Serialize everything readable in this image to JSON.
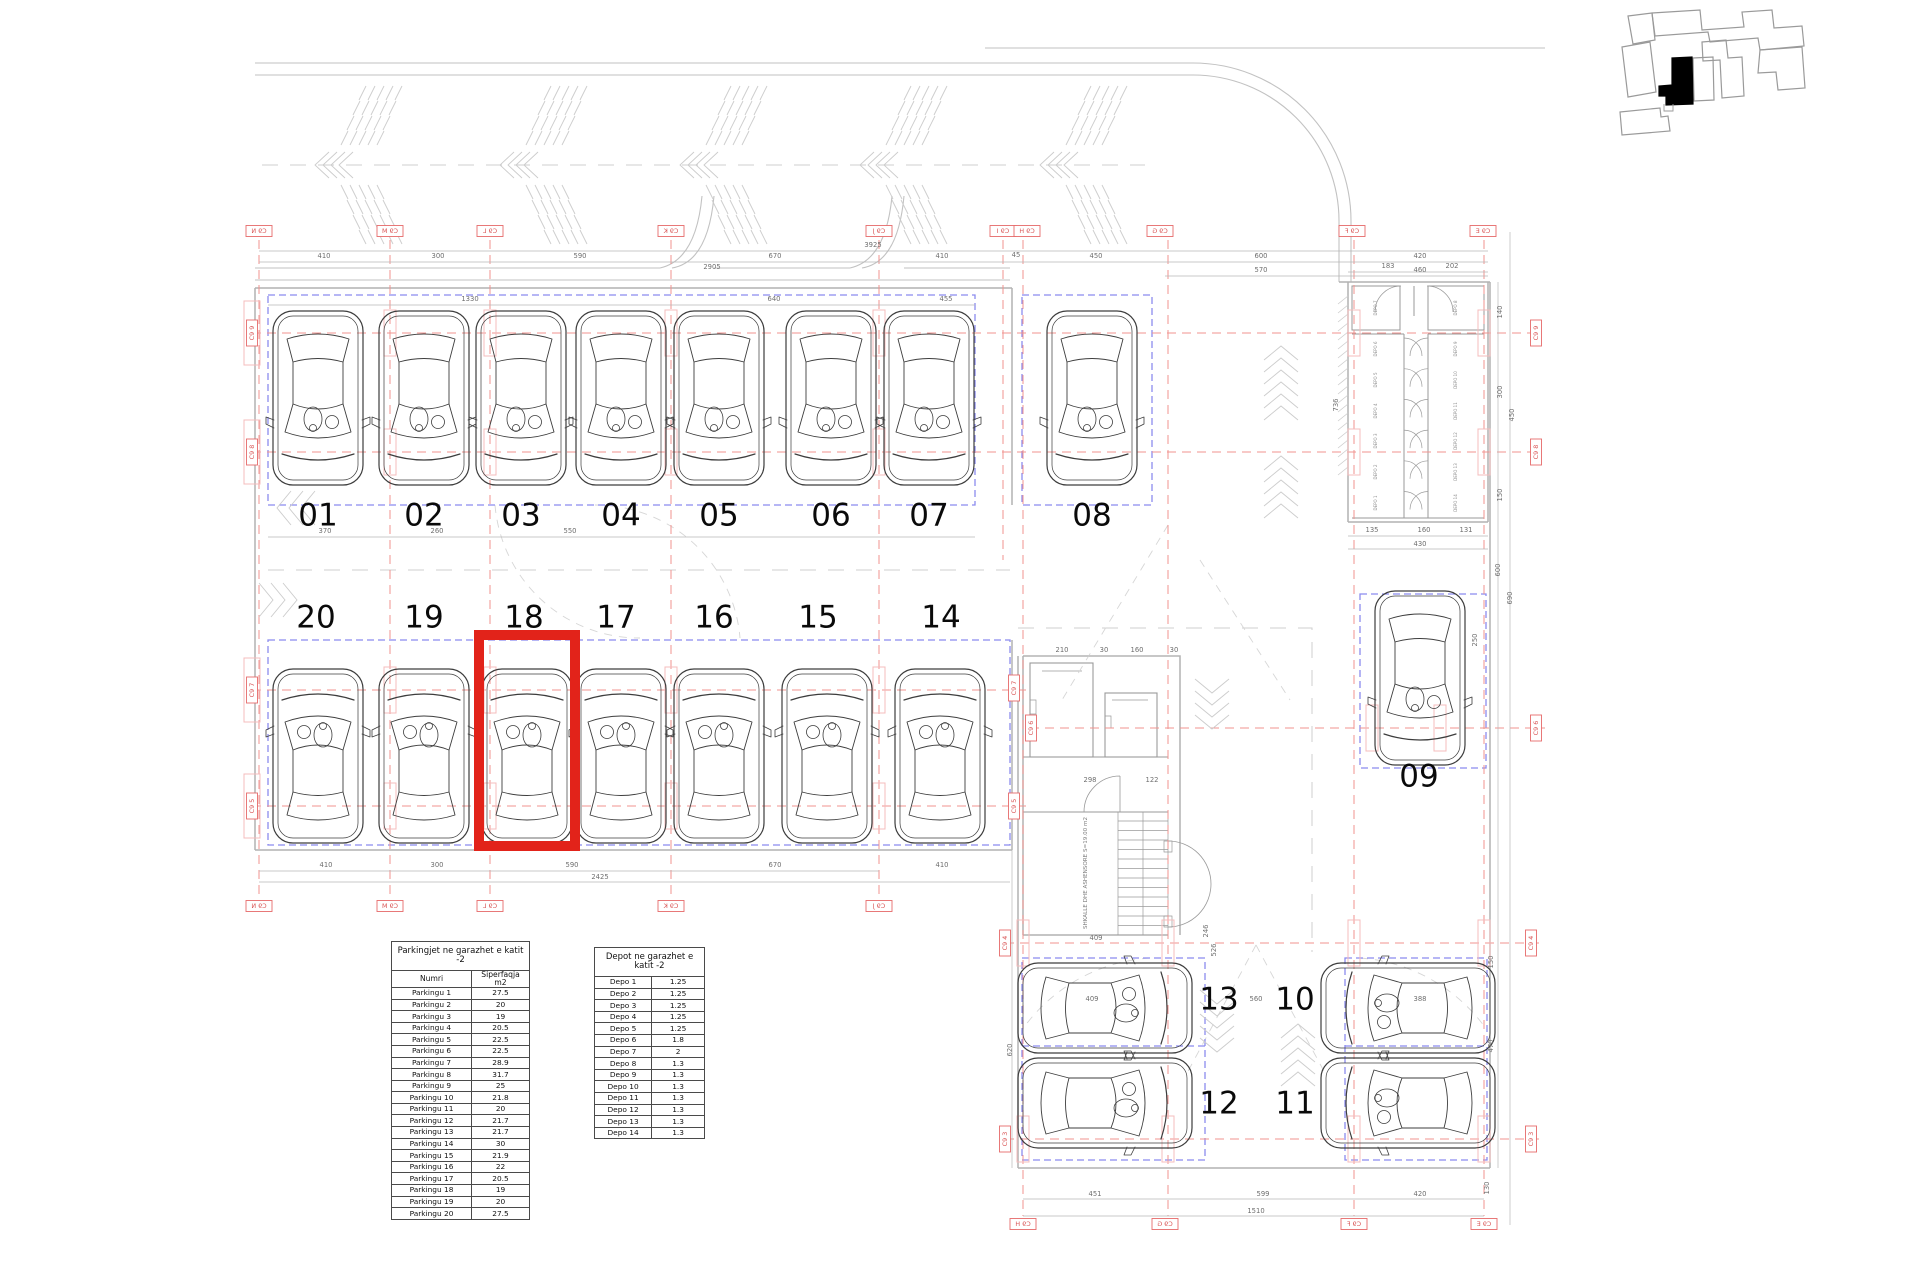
{
  "drawing": {
    "highlighted_spot": "18",
    "stair_label": "SHKALLE DHE ASHENSORE S=19.00 m2",
    "parking_spot_labels": [
      "01",
      "02",
      "03",
      "04",
      "05",
      "06",
      "07",
      "08",
      "20",
      "19",
      "18",
      "17",
      "16",
      "15",
      "14",
      "09",
      "13",
      "10",
      "12",
      "11"
    ],
    "grid_bubbles": [
      "C9 N",
      "C9 M",
      "C9 L",
      "C9 K",
      "C9 J",
      "C9 I",
      "C9 H",
      "C9 G",
      "C9 F",
      "C9 E",
      "C9 N",
      "C9 M",
      "C9 L",
      "C9 K",
      "C9 J",
      "C9 H",
      "C9 G",
      "C9 F",
      "C9 E",
      "C9 9",
      "C9 8",
      "C9 7",
      "C9 5",
      "C9 7",
      "C9 5",
      "C9 6",
      "C9 4",
      "C9 3",
      "C9 9",
      "C9 8",
      "C9 6",
      "C9 4",
      "C9 3"
    ],
    "dimensions": [
      "410",
      "300",
      "590",
      "670",
      "410",
      "45",
      "450",
      "600",
      "420",
      "570",
      "460",
      "3925",
      "2905",
      "1330",
      "640",
      "455",
      "370",
      "260",
      "550",
      "410",
      "300",
      "590",
      "670",
      "410",
      "2425",
      "183",
      "202",
      "135",
      "160",
      "131",
      "430",
      "736",
      "140",
      "300",
      "450",
      "150",
      "600",
      "690",
      "250",
      "210",
      "30",
      "160",
      "30",
      "298",
      "122",
      "409",
      "246",
      "526",
      "560",
      "409",
      "388",
      "620",
      "470",
      "150",
      "130",
      "451",
      "599",
      "420",
      "1510"
    ],
    "depot_rooms": [
      "DEPO 7",
      "DEPO 6",
      "DEPO 5",
      "DEPO 4",
      "DEPO 3",
      "DEPO 2",
      "DEPO 1",
      "DEPO 8",
      "DEPO 9",
      "DEPO 10",
      "DEPO 11",
      "DEPO 12",
      "DEPO 13",
      "DEPO 14"
    ]
  },
  "tables": {
    "parking": {
      "title": "Parkingjet ne garazhet e katit -2",
      "columns": [
        "Numri",
        "Siperfaqja m2"
      ],
      "rows": [
        [
          "Parkingu 1",
          "27.5"
        ],
        [
          "Parkingu 2",
          "20"
        ],
        [
          "Parkingu 3",
          "19"
        ],
        [
          "Parkingu 4",
          "20.5"
        ],
        [
          "Parkingu 5",
          "22.5"
        ],
        [
          "Parkingu 6",
          "22.5"
        ],
        [
          "Parkingu 7",
          "28.9"
        ],
        [
          "Parkingu 8",
          "31.7"
        ],
        [
          "Parkingu 9",
          "25"
        ],
        [
          "Parkingu 10",
          "21.8"
        ],
        [
          "Parkingu 11",
          "20"
        ],
        [
          "Parkingu 12",
          "21.7"
        ],
        [
          "Parkingu 13",
          "21.7"
        ],
        [
          "Parkingu 14",
          "30"
        ],
        [
          "Parkingu 15",
          "21.9"
        ],
        [
          "Parkingu 16",
          "22"
        ],
        [
          "Parkingu 17",
          "20.5"
        ],
        [
          "Parkingu 18",
          "19"
        ],
        [
          "Parkingu 19",
          "20"
        ],
        [
          "Parkingu 20",
          "27.5"
        ]
      ]
    },
    "depot": {
      "title": "Depot ne garazhet e katit -2",
      "rows": [
        [
          "Depo 1",
          "1.25"
        ],
        [
          "Depo 2",
          "1.25"
        ],
        [
          "Depo 3",
          "1.25"
        ],
        [
          "Depo 4",
          "1.25"
        ],
        [
          "Depo 5",
          "1.25"
        ],
        [
          "Depo 6",
          "1.8"
        ],
        [
          "Depo 7",
          "2"
        ],
        [
          "Depo 8",
          "1.3"
        ],
        [
          "Depo 9",
          "1.3"
        ],
        [
          "Depo 10",
          "1.3"
        ],
        [
          "Depo 11",
          "1.3"
        ],
        [
          "Depo 12",
          "1.3"
        ],
        [
          "Depo 13",
          "1.3"
        ],
        [
          "Depo 14",
          "1.3"
        ]
      ]
    }
  },
  "colors": {
    "highlight_red": "#e2231a",
    "grid_red": "#f0938f",
    "zone_blue": "#8b8bef",
    "line_gray": "#c2c2c2",
    "car_gray": "#3d3d3d"
  }
}
